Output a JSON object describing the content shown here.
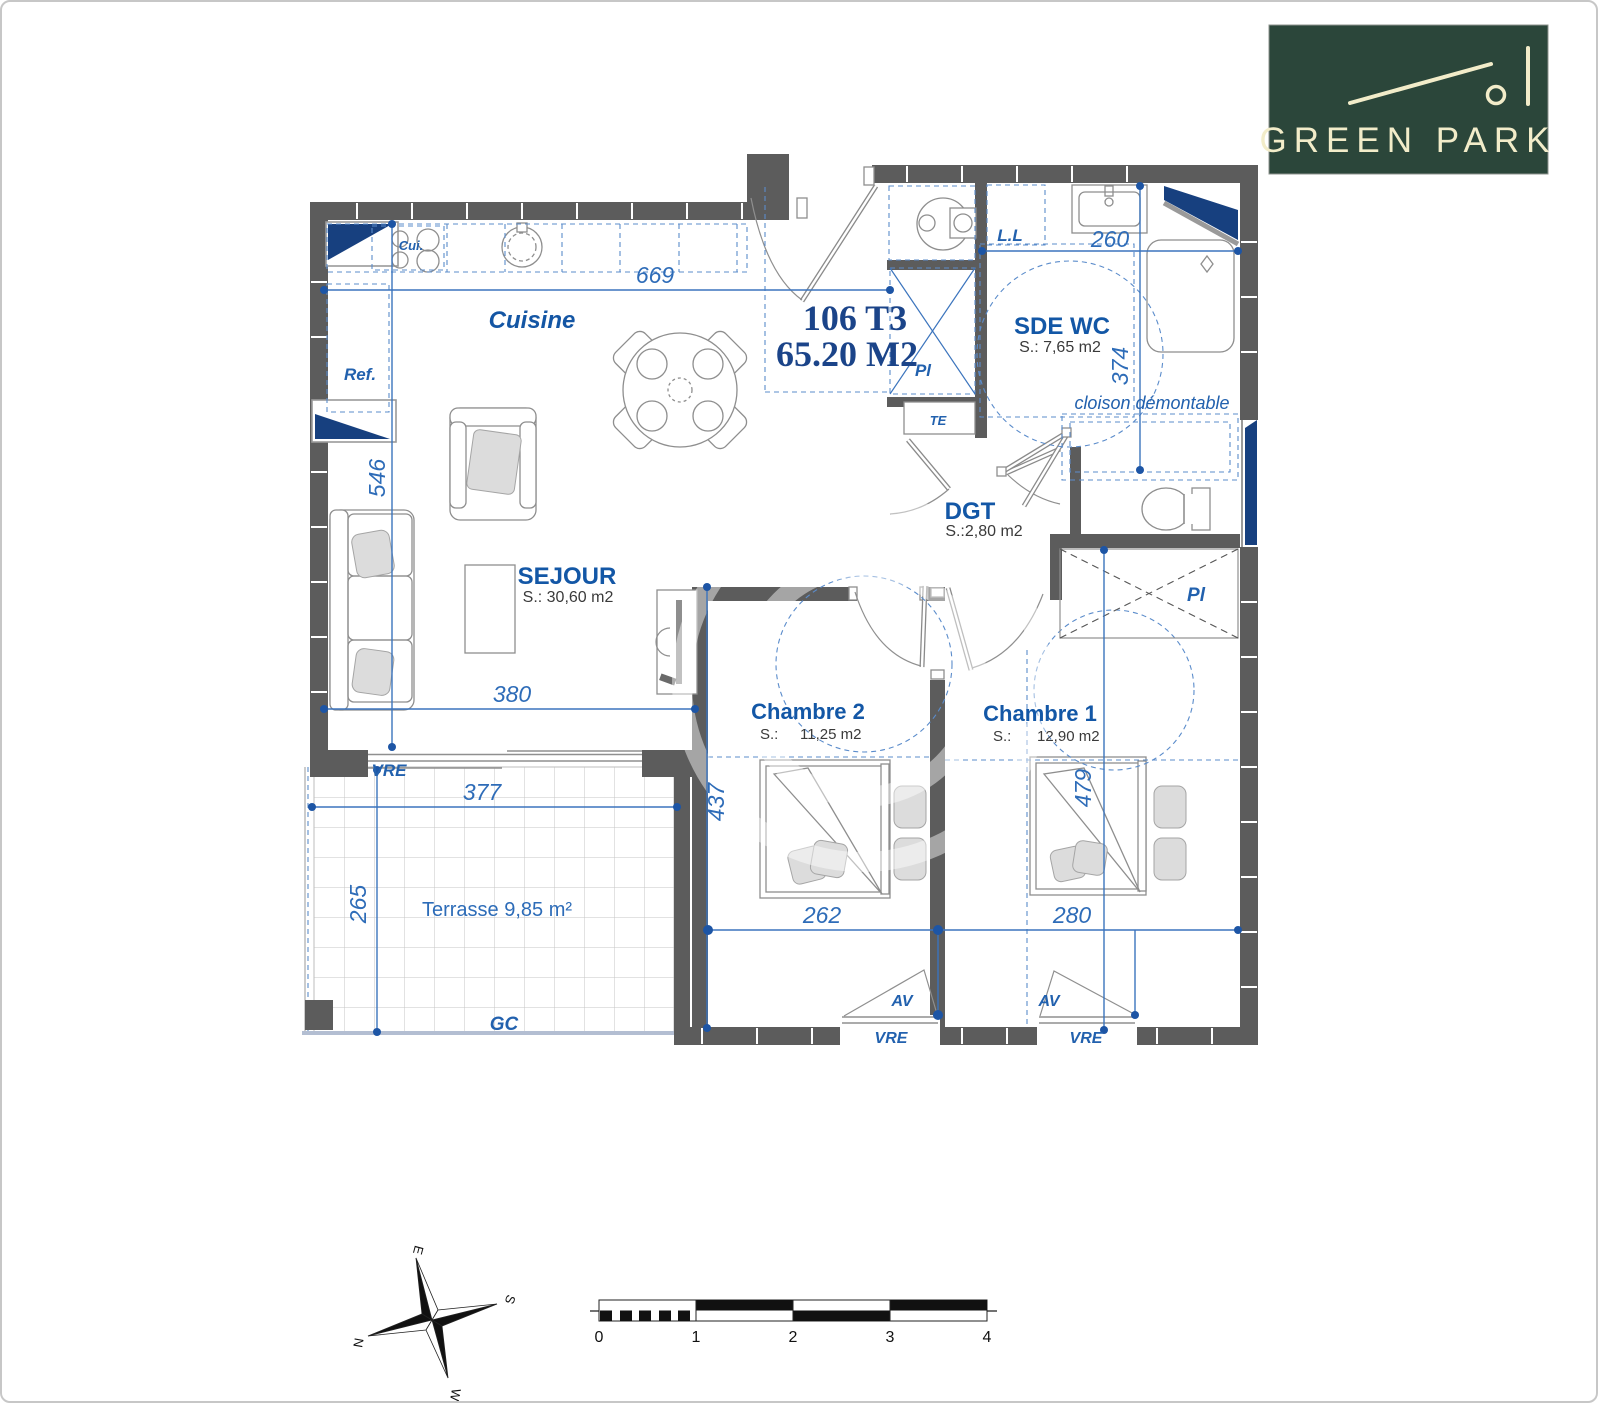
{
  "logo": {
    "brand": "GREEN PARK"
  },
  "title": {
    "line1": "106 T3",
    "line2": "65.20 M2"
  },
  "rooms": {
    "cuisine": {
      "name": "Cuisine"
    },
    "sejour": {
      "name": "SEJOUR",
      "area": "S.:  30,60 m2"
    },
    "sde_wc": {
      "name": "SDE WC",
      "area": "S.:   7,65 m2"
    },
    "dgt": {
      "name": "DGT",
      "area": "S.:2,80 m2"
    },
    "chambre2": {
      "name": "Chambre 2",
      "area_prefix": "S.:",
      "area_value": "11,25 m2"
    },
    "chambre1": {
      "name": "Chambre 1",
      "area_prefix": "S.:",
      "area_value": "12,90 m2"
    },
    "terrasse": {
      "name": "Terrasse 9,85 m²"
    }
  },
  "annotations": {
    "cui": "Cui.",
    "ref": "Ref.",
    "ll": "L.L",
    "pl_entry": "Pl",
    "te": "TE",
    "pl_dressing": "Pl",
    "cloison": "cloison démontable",
    "vre_sejour": "VRE",
    "vre_chambre2": "VRE",
    "vre_chambre1": "VRE",
    "av_chambre2": "AV",
    "av_chambre1": "AV",
    "gc": "GC"
  },
  "dimensions": {
    "kitchen_width": "669",
    "sejour_height": "546",
    "sejour_width": "380",
    "terrasse_width": "377",
    "terrasse_height": "265",
    "chambre2_height": "437",
    "chambre2_width": "262",
    "chambre1_width": "280",
    "chambre1_height": "479",
    "sde_width": "260",
    "sde_height": "374"
  },
  "compass": {
    "east": "E",
    "south": "S",
    "north": "N",
    "west": "W"
  },
  "scale_bar": {
    "ticks": [
      "0",
      "1",
      "2",
      "3",
      "4"
    ]
  },
  "colors": {
    "wall": "#5c5c5c",
    "annotation_blue": "#2e6cb8",
    "window_navy": "#17407f",
    "logo_green": "#2b463a",
    "logo_cream": "#f2ecc9"
  }
}
